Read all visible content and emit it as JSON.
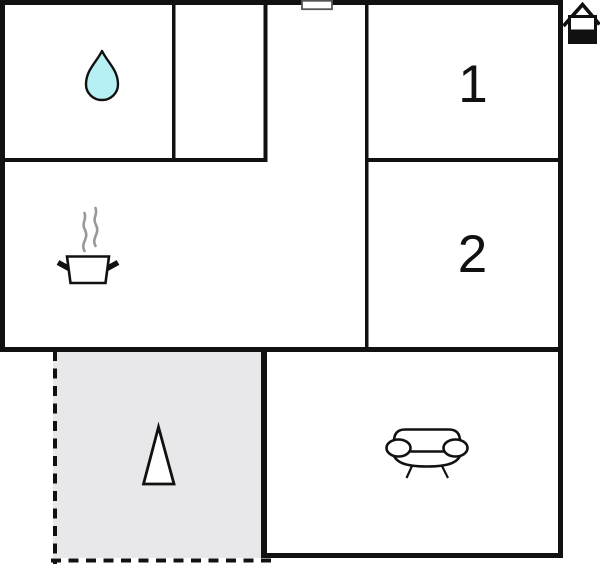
{
  "plan": {
    "name": "apartment-floor-plan",
    "rooms": {
      "bathroom": {
        "icon": "water-drop-icon"
      },
      "bedroom1": {
        "label": "1"
      },
      "bedroom2": {
        "label": "2"
      },
      "kitchen": {
        "icon": "cooking-pot-icon"
      },
      "living_room": {
        "icon": "sofa-icon"
      },
      "terrace": {
        "icon": "tree-icon"
      }
    },
    "entrance": {
      "icon": "door-icon"
    },
    "logo": {
      "icon": "house-icon"
    }
  },
  "colors": {
    "wall": "#111111",
    "background": "#ffffff",
    "terrace_fill": "#e8e8ea",
    "water_drop_fill": "#b7f0f4",
    "icon_outline": "#111111",
    "steam": "#999999",
    "door_outline": "#555555"
  }
}
